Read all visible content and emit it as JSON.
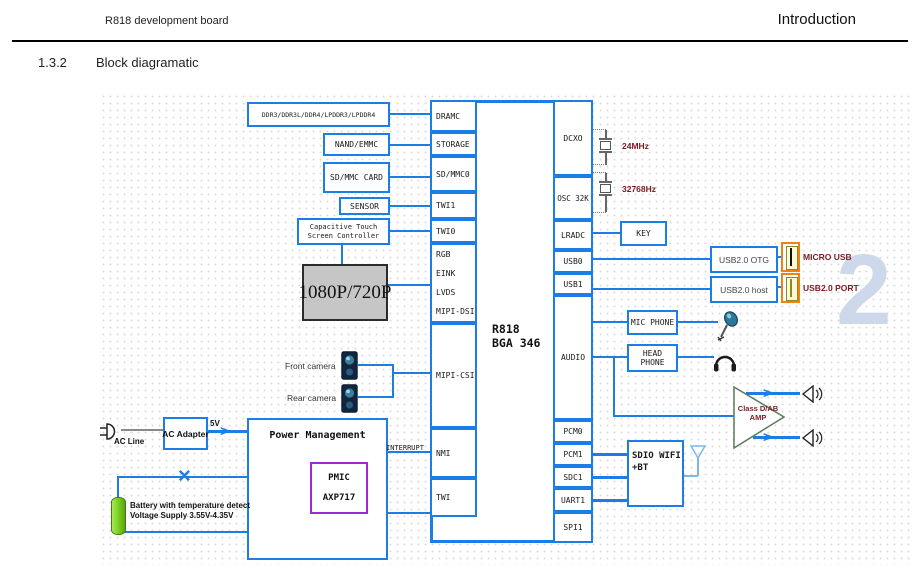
{
  "header": {
    "left": "R818 development board",
    "right": "Introduction"
  },
  "section": {
    "number": "1.3.2",
    "title": "Block diagramatic"
  },
  "chip": {
    "title1": "R818",
    "title2": "BGA 346",
    "left_ports": {
      "dramc": "DRAMC",
      "storage": "STORAGE",
      "sdmmc0": "SD/MMC0",
      "twi1": "TWI1",
      "twi0": "TWI0",
      "rgb": "RGB",
      "eink": "EINK",
      "lvds": "LVDS",
      "mipi_dsi": "MIPI-DSI",
      "mipi_csi": "MIPI-CSI",
      "nmi": "NMI",
      "twi": "TWI"
    },
    "right_ports": {
      "dcxo": "DCXO",
      "osc32k": "OSC 32K",
      "lradc": "LRADC",
      "usb0": "USB0",
      "usb1": "USB1",
      "audio": "AUDIO",
      "pcm0": "PCM0",
      "pcm1": "PCM1",
      "sdc1": "SDC1",
      "uart1": "UART1",
      "spi1": "SPI1"
    }
  },
  "periph": {
    "ddr": "DDR3/DDR3L/DDR4/LPDDR3/LPDDR4",
    "nand": "NAND/EMMC",
    "sd_card": "SD/MMC CARD",
    "sensor": "SENSOR",
    "touch_l1": "Capacitive Touch",
    "touch_l2": "Screen Controller",
    "display": "1080P/720P",
    "front_camera": "Front camera",
    "rear_camera": "Rear camera"
  },
  "clocks": {
    "xtal_24mhz": "24MHz",
    "xtal_32k": "32768Hz"
  },
  "right": {
    "key": "KEY",
    "usb_otg": "USB2.0 OTG",
    "usb_host": "USB2.0 host",
    "micro_usb": "MICRO USB",
    "usb_port": "USB2.0 PORT",
    "mic_phone": "MIC PHONE",
    "head_phone": "HEAD PHONE",
    "amp_l1": "Class D/AB",
    "amp_l2": "AMP",
    "sdio_l1": "SDIO WIFI",
    "sdio_l2": "+BT"
  },
  "power": {
    "ac_line": "AC Line",
    "ac_adapter": "AC Adapter",
    "v5": "5V",
    "pm_title": "Power Management",
    "pmic_l1": "PMIC",
    "pmic_l2": "AXP717",
    "interrupt": "INTERRUPT",
    "battery_l1": "Battery with temperature detect",
    "battery_l2": "Voltage Supply 3.55V-4.35V"
  },
  "watermark": {
    "glyph": "2"
  },
  "colors": {
    "line_blue": "#1a7ee6",
    "label_maroon": "#7b1b24",
    "pmic_purple": "#9c2bd0",
    "connector_orange": "#f08019",
    "battery_green": "#7ed321",
    "display_gray": "#c6c6c6"
  }
}
